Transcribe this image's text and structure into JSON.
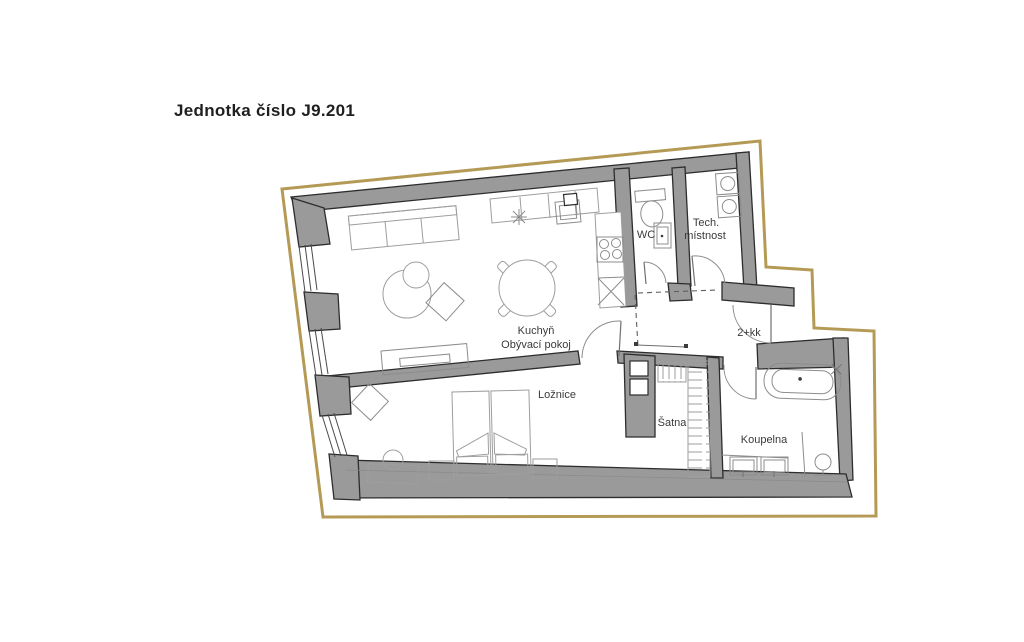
{
  "title": "Jednotka číslo J9.201",
  "plan": {
    "unit_type": "2+kk",
    "labels": {
      "kitchen": "Kuchyň",
      "living": "Obývací pokoj",
      "wc": "WC",
      "tech_line1": "Tech.",
      "tech_line2": "místnost",
      "bedroom": "Ložnice",
      "closet": "Šatna",
      "bathroom": "Koupelna"
    },
    "colors": {
      "boundary": "#b49a55",
      "wall_fill": "#9a9a9a",
      "wall_outline": "#2d2d2d",
      "furniture_stroke": "#9e9e9e",
      "label_text": "#3a3a3a",
      "background": "#ffffff"
    }
  }
}
